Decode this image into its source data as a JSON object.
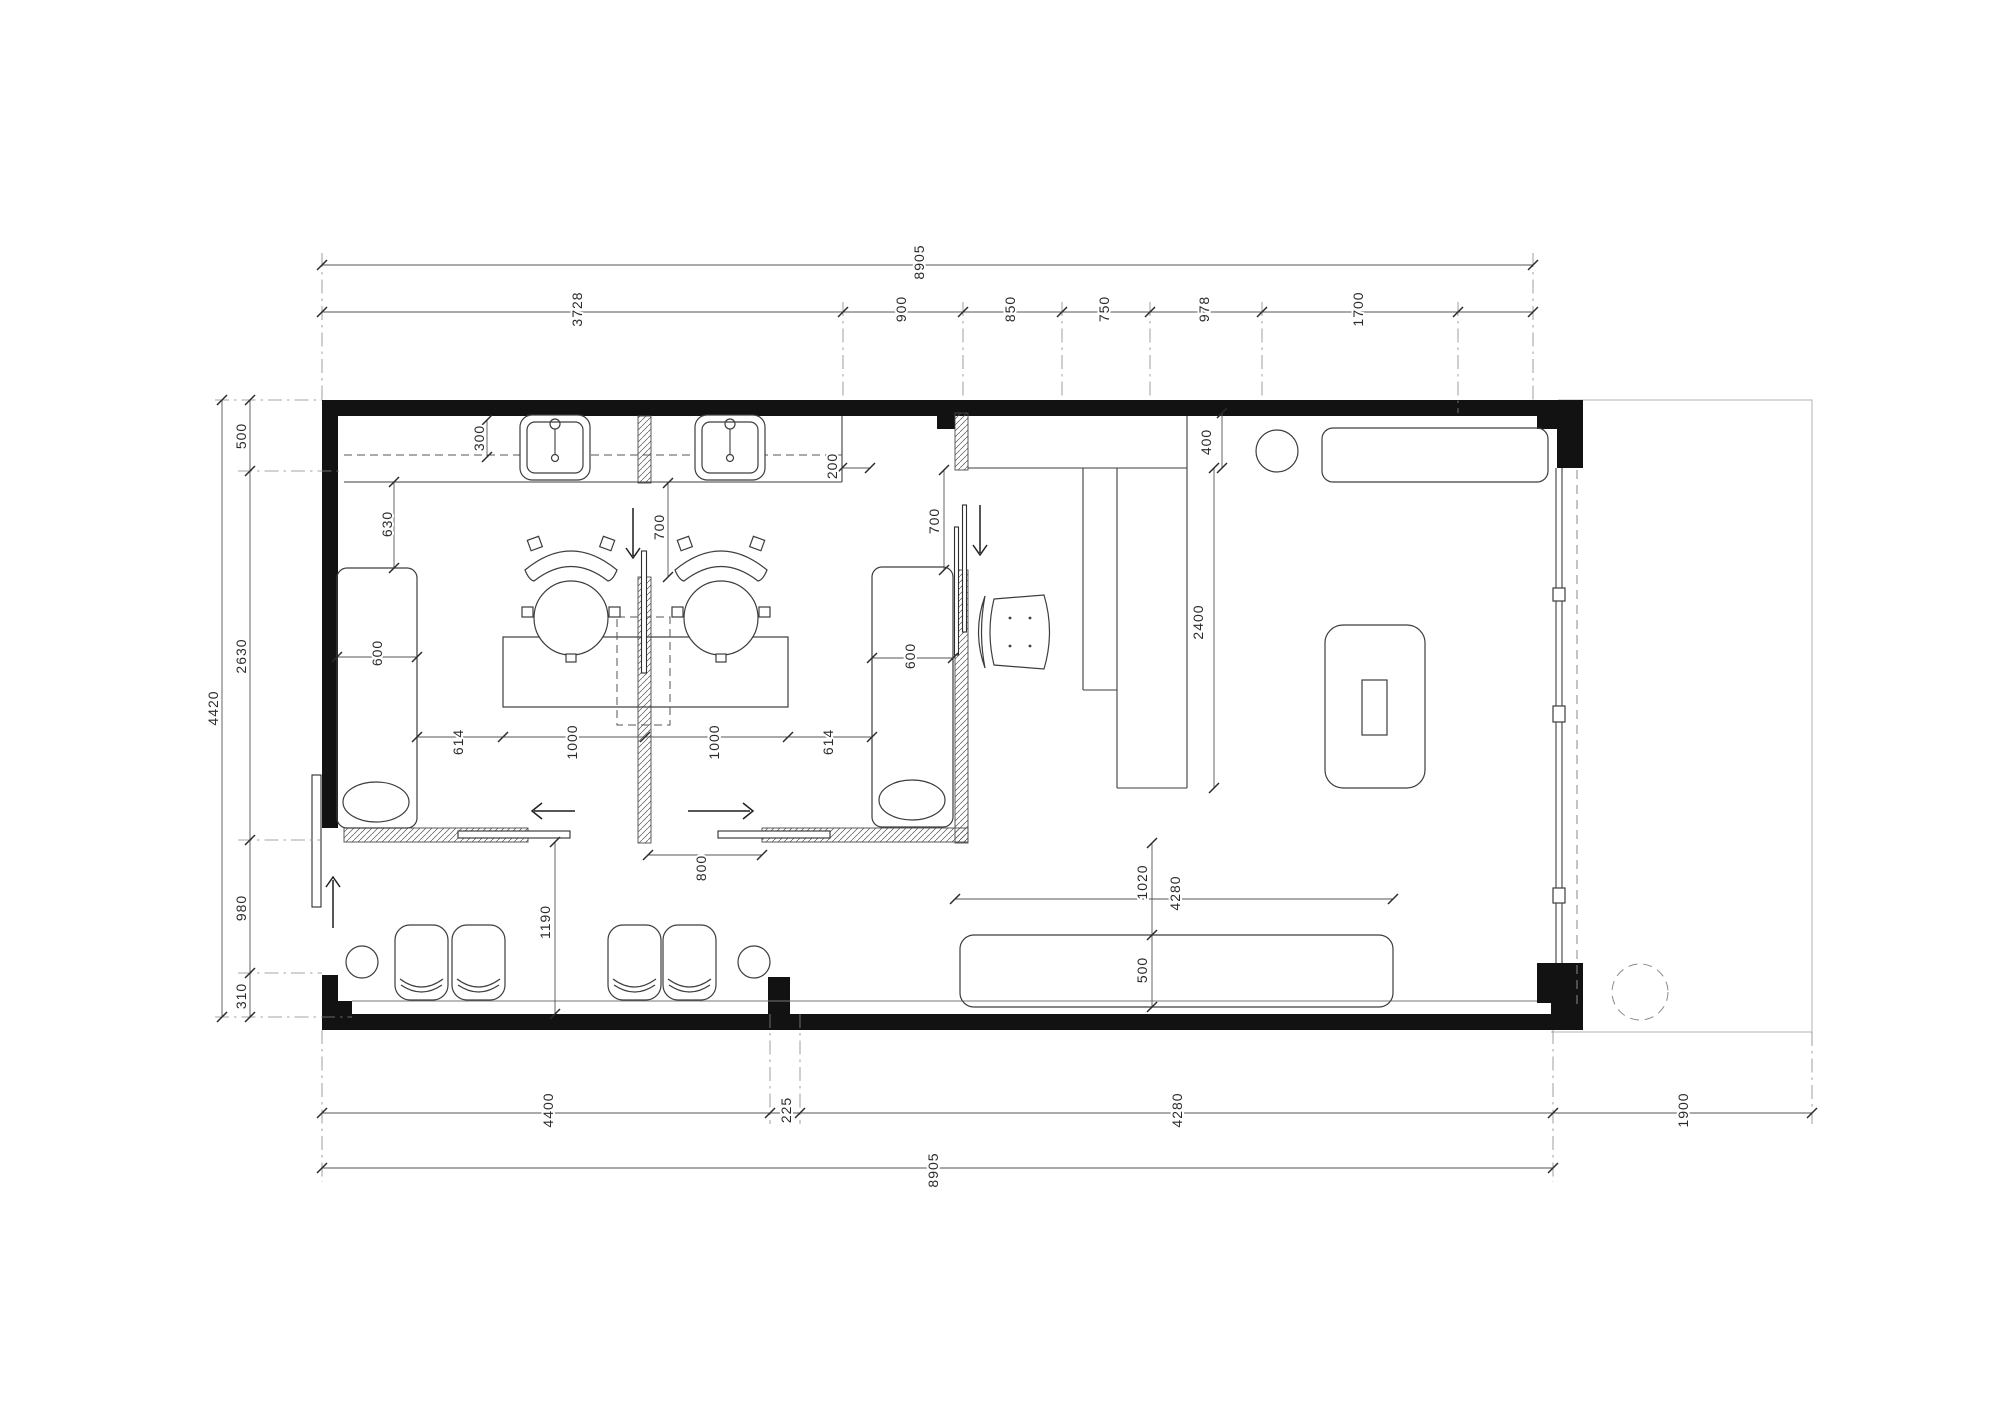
{
  "drawing": {
    "type": "architectural floor plan",
    "units": "mm",
    "overall_width": "8905",
    "overall_height": "4420",
    "top_chain": [
      "3728",
      "900",
      "850",
      "750",
      "978",
      "1700"
    ],
    "left_chain": [
      "500",
      "2630",
      "980",
      "310"
    ],
    "bottom_chain": [
      "4400",
      "225",
      "4280",
      "1900"
    ],
    "interior_dims": [
      "300",
      "630",
      "600",
      "700",
      "200",
      "700",
      "400",
      "2400",
      "600",
      "614",
      "1000",
      "1000",
      "614",
      "800",
      "1190",
      "1020",
      "4280",
      "500"
    ]
  },
  "dim_labels": [
    {
      "text": "8905",
      "x": 919,
      "y": 262
    },
    {
      "text": "3728",
      "x": 577,
      "y": 309
    },
    {
      "text": "900",
      "x": 901,
      "y": 309
    },
    {
      "text": "850",
      "x": 1010,
      "y": 309
    },
    {
      "text": "750",
      "x": 1104,
      "y": 309
    },
    {
      "text": "978",
      "x": 1204,
      "y": 309
    },
    {
      "text": "1700",
      "x": 1358,
      "y": 309
    },
    {
      "text": "4420",
      "x": 213,
      "y": 708
    },
    {
      "text": "500",
      "x": 241,
      "y": 436
    },
    {
      "text": "2630",
      "x": 241,
      "y": 656
    },
    {
      "text": "980",
      "x": 241,
      "y": 908
    },
    {
      "text": "310",
      "x": 241,
      "y": 996
    },
    {
      "text": "4400",
      "x": 548,
      "y": 1110
    },
    {
      "text": "225",
      "x": 786,
      "y": 1110
    },
    {
      "text": "4280",
      "x": 1177,
      "y": 1110
    },
    {
      "text": "1900",
      "x": 1683,
      "y": 1110
    },
    {
      "text": "8905",
      "x": 933,
      "y": 1170
    },
    {
      "text": "300",
      "x": 479,
      "y": 438
    },
    {
      "text": "630",
      "x": 387,
      "y": 524
    },
    {
      "text": "600",
      "x": 377,
      "y": 653
    },
    {
      "text": "700",
      "x": 659,
      "y": 527
    },
    {
      "text": "200",
      "x": 832,
      "y": 466
    },
    {
      "text": "700",
      "x": 934,
      "y": 521
    },
    {
      "text": "400",
      "x": 1206,
      "y": 442
    },
    {
      "text": "2400",
      "x": 1198,
      "y": 622
    },
    {
      "text": "600",
      "x": 910,
      "y": 656
    },
    {
      "text": "614",
      "x": 458,
      "y": 742
    },
    {
      "text": "1000",
      "x": 572,
      "y": 742
    },
    {
      "text": "1000",
      "x": 714,
      "y": 742
    },
    {
      "text": "614",
      "x": 828,
      "y": 742
    },
    {
      "text": "800",
      "x": 701,
      "y": 868
    },
    {
      "text": "1190",
      "x": 545,
      "y": 922
    },
    {
      "text": "1020",
      "x": 1142,
      "y": 882
    },
    {
      "text": "4280",
      "x": 1175,
      "y": 893
    },
    {
      "text": "500",
      "x": 1142,
      "y": 970
    }
  ]
}
